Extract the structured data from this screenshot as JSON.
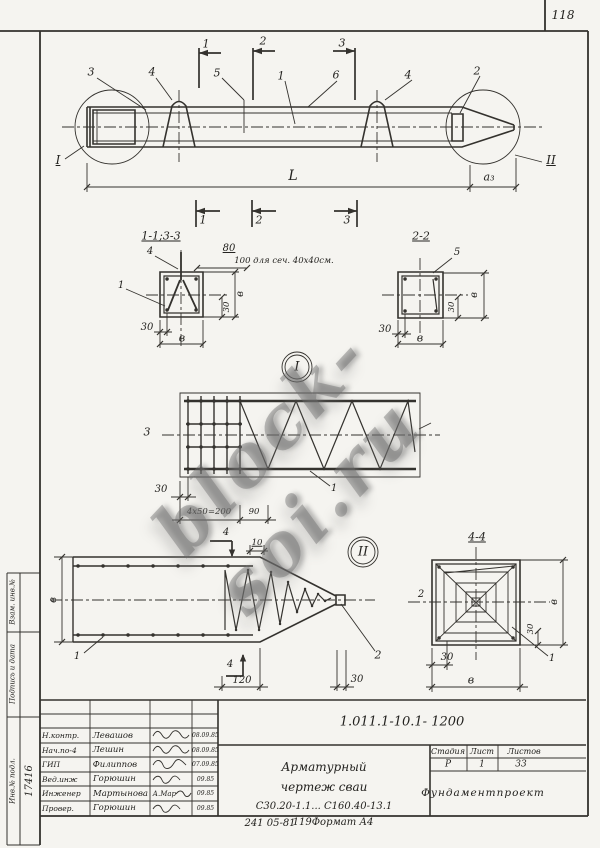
{
  "page_number": "118",
  "watermark": "block-soi.ru",
  "stamp_strip": {
    "rev_label": "Взам. инв.№",
    "sign_label": "Подпись и дата",
    "inv_label": "Инв.№ подл.",
    "inventory_number": "17416"
  },
  "footer": {
    "order_note": "241 05-81",
    "format_note": "119Формат А4"
  },
  "title_block": {
    "doc_number": "1.011.1-10.1- 1200",
    "rows": [
      {
        "role": "Н.контр.",
        "name": "Левашов",
        "sig": "",
        "date": "08.09.85"
      },
      {
        "role": "Нач.по-4",
        "name": "Лешин",
        "sig": "",
        "date": "08.09.85"
      },
      {
        "role": "ГИП",
        "name": "Филиппов",
        "sig": "",
        "date": "07.09.85"
      },
      {
        "role": "Вед.инж",
        "name": "Горюшин",
        "sig": "",
        "date": "09.85"
      },
      {
        "role": "Инженер",
        "name": "Мартынова",
        "sig": "А.Мар",
        "date": "09.85"
      },
      {
        "role": "Провер.",
        "name": "Горюшин",
        "sig": "",
        "date": "09.85"
      }
    ],
    "title_lines": [
      "Арматурный",
      "чертеж  сваи",
      "С30.20-1.1... С160.40-13.1"
    ],
    "stage_label": "Стадия",
    "sheet_label": "Лист",
    "sheets_label": "Листов",
    "stage": "Р",
    "sheet": "1",
    "sheets": "33",
    "organization": "Фундаментпроект"
  },
  "drawing": {
    "labels": [
      {
        "t": "1",
        "x": 206,
        "y": 44,
        "fs": 11,
        "n": "section-mark-1-top"
      },
      {
        "t": "2",
        "x": 263,
        "y": 41,
        "fs": 11,
        "n": "section-mark-2-top"
      },
      {
        "t": "3",
        "x": 342,
        "y": 43,
        "fs": 11,
        "n": "section-mark-3-top"
      },
      {
        "t": "3",
        "x": 91,
        "y": 72,
        "fs": 11,
        "n": "callout-3"
      },
      {
        "t": "4",
        "x": 152,
        "y": 72,
        "fs": 11,
        "n": "callout-4"
      },
      {
        "t": "5",
        "x": 217,
        "y": 73,
        "fs": 11,
        "n": "callout-5"
      },
      {
        "t": "1",
        "x": 281,
        "y": 76,
        "fs": 11,
        "n": "callout-1"
      },
      {
        "t": "6",
        "x": 336,
        "y": 75,
        "fs": 11,
        "n": "callout-6"
      },
      {
        "t": "4",
        "x": 408,
        "y": 75,
        "fs": 11,
        "n": "callout-4b"
      },
      {
        "t": "2",
        "x": 477,
        "y": 71,
        "fs": 11,
        "n": "callout-2"
      },
      {
        "t": "I",
        "x": 58,
        "y": 160,
        "fs": 12,
        "u": 1,
        "n": "detail-ref-I"
      },
      {
        "t": "II",
        "x": 551,
        "y": 160,
        "fs": 12,
        "u": 1,
        "n": "detail-ref-II"
      },
      {
        "t": "L",
        "x": 293,
        "y": 176,
        "fs": 14,
        "n": "dim-L"
      },
      {
        "t": "а₃",
        "x": 489,
        "y": 177,
        "fs": 11,
        "n": "dim-a3"
      },
      {
        "t": "1",
        "x": 203,
        "y": 220,
        "fs": 11,
        "n": "section-mark-1-bottom"
      },
      {
        "t": "2",
        "x": 259,
        "y": 220,
        "fs": 11,
        "n": "section-mark-2-bottom"
      },
      {
        "t": "3",
        "x": 347,
        "y": 220,
        "fs": 11,
        "n": "section-mark-3-bottom"
      },
      {
        "t": "1-1;3-3",
        "x": 161,
        "y": 236,
        "fs": 11,
        "u": 1,
        "n": "section-title-1-1-3-3"
      },
      {
        "t": "4",
        "x": 150,
        "y": 252,
        "fs": 10,
        "n": "callout-4-sec11"
      },
      {
        "t": "1",
        "x": 121,
        "y": 286,
        "fs": 10,
        "n": "callout-1-sec11"
      },
      {
        "t": "80",
        "x": 229,
        "y": 249,
        "fs": 10,
        "u": 1,
        "n": "dim-80"
      },
      {
        "t": "100 для сеч. 40х40см.",
        "x": 284,
        "y": 261,
        "fs": 8.5,
        "n": "note-100-for-40x40"
      },
      {
        "t": "в",
        "x": 241,
        "y": 294,
        "fs": 10,
        "r": -90,
        "n": "dim-v-sec11-right"
      },
      {
        "t": "30",
        "x": 227,
        "y": 307,
        "fs": 8.5,
        "r": -90,
        "n": "dim-30-sec11-v"
      },
      {
        "t": "30",
        "x": 147,
        "y": 328,
        "fs": 10,
        "n": "dim-30-sec11-h"
      },
      {
        "t": "в",
        "x": 182,
        "y": 338,
        "fs": 11,
        "n": "dim-v-sec11-bottom"
      },
      {
        "t": "2-2",
        "x": 421,
        "y": 236,
        "fs": 11,
        "u": 1,
        "n": "section-title-2-2"
      },
      {
        "t": "5",
        "x": 457,
        "y": 253,
        "fs": 10,
        "n": "callout-5-sec22"
      },
      {
        "t": "в",
        "x": 475,
        "y": 295,
        "fs": 10,
        "r": -90,
        "n": "dim-v-sec22-right"
      },
      {
        "t": "30",
        "x": 452,
        "y": 307,
        "fs": 8.5,
        "r": -90,
        "n": "dim-30-sec22-v"
      },
      {
        "t": "30",
        "x": 385,
        "y": 330,
        "fs": 10,
        "n": "dim-30-sec22-h"
      },
      {
        "t": "в",
        "x": 420,
        "y": 338,
        "fs": 11,
        "n": "dim-v-sec22-bottom"
      },
      {
        "t": "I",
        "x": 297,
        "y": 367,
        "fs": 13,
        "n": "detail-I-bubble-label"
      },
      {
        "t": "3",
        "x": 147,
        "y": 432,
        "fs": 11,
        "n": "callout-3-detail-I"
      },
      {
        "t": "1",
        "x": 334,
        "y": 489,
        "fs": 10,
        "n": "callout-1-detail-I"
      },
      {
        "t": "30",
        "x": 161,
        "y": 490,
        "fs": 10,
        "n": "dim-30-detail-I"
      },
      {
        "t": "4х50=200",
        "x": 209,
        "y": 512,
        "fs": 8.5,
        "n": "dim-4x50-200"
      },
      {
        "t": "90",
        "x": 254,
        "y": 512,
        "fs": 8.5,
        "n": "dim-90"
      },
      {
        "t": "4",
        "x": 226,
        "y": 533,
        "fs": 10,
        "n": "section-mark-4-top"
      },
      {
        "t": "10",
        "x": 257,
        "y": 543,
        "fs": 8.5,
        "u": 1,
        "n": "dim-10"
      },
      {
        "t": "II",
        "x": 363,
        "y": 552,
        "fs": 13,
        "n": "detail-II-bubble-label"
      },
      {
        "t": "в",
        "x": 54,
        "y": 600,
        "fs": 10,
        "r": -90,
        "n": "dim-v-detail-II"
      },
      {
        "t": "1",
        "x": 77,
        "y": 657,
        "fs": 10,
        "n": "callout-1-detail-II"
      },
      {
        "t": "2",
        "x": 378,
        "y": 655,
        "fs": 11,
        "n": "callout-2-detail-II"
      },
      {
        "t": "4",
        "x": 230,
        "y": 665,
        "fs": 10,
        "n": "section-mark-4-bottom"
      },
      {
        "t": "120",
        "x": 242,
        "y": 681,
        "fs": 10,
        "n": "dim-120"
      },
      {
        "t": "30",
        "x": 357,
        "y": 680,
        "fs": 10,
        "n": "dim-30-tip"
      },
      {
        "t": "4-4",
        "x": 477,
        "y": 537,
        "fs": 11,
        "u": 1,
        "n": "section-title-4-4"
      },
      {
        "t": "2",
        "x": 421,
        "y": 595,
        "fs": 10,
        "n": "callout-2-sec44"
      },
      {
        "t": "1",
        "x": 552,
        "y": 659,
        "fs": 10,
        "n": "callout-1-sec44"
      },
      {
        "t": "в",
        "x": 555,
        "y": 602,
        "fs": 10,
        "r": -90,
        "n": "dim-v-sec44-right"
      },
      {
        "t": "30",
        "x": 531,
        "y": 629,
        "fs": 8.5,
        "r": -90,
        "n": "dim-30-sec44-v"
      },
      {
        "t": "30",
        "x": 447,
        "y": 658,
        "fs": 10,
        "n": "dim-30-sec44-h"
      },
      {
        "t": "в",
        "x": 471,
        "y": 680,
        "fs": 11,
        "n": "dim-v-sec44-bottom"
      }
    ]
  }
}
